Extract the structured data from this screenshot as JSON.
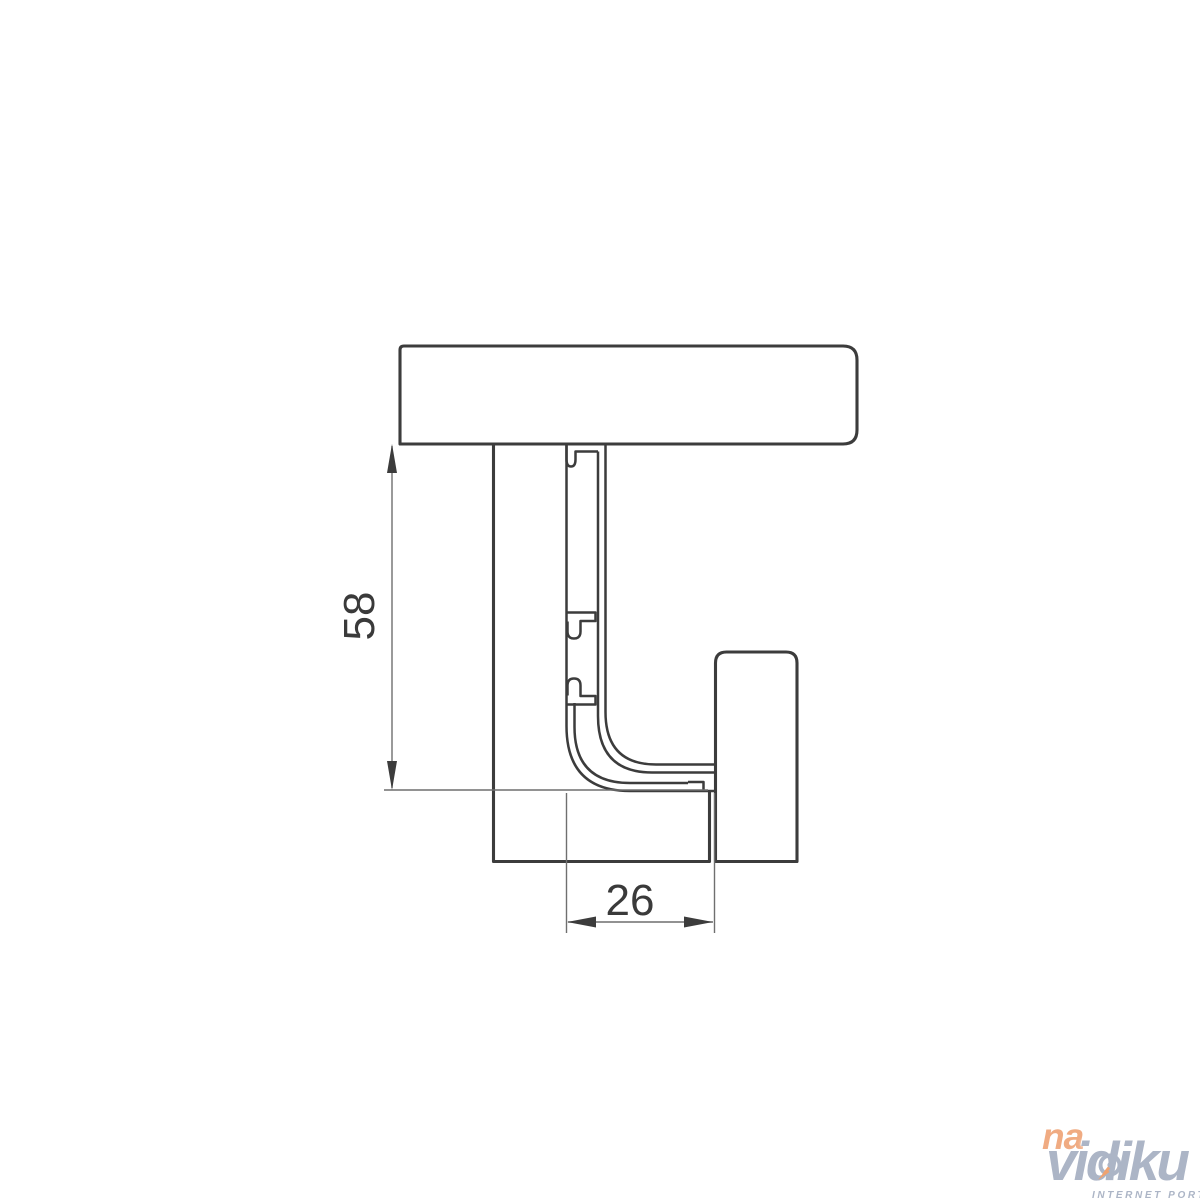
{
  "drawing": {
    "type": "technical-cross-section",
    "subject": "gola-handle-profile-installation",
    "dimensions": {
      "height": {
        "value": "58",
        "orientation": "vertical"
      },
      "width": {
        "value": "26",
        "orientation": "horizontal"
      }
    },
    "parts": [
      "countertop",
      "cabinet-panel",
      "gola-c-profile",
      "door-panel"
    ]
  },
  "watermark": {
    "prefix": "na",
    "name": "vidiku",
    "tagline": "INTERNET PORTAL"
  },
  "colors": {
    "background": "#ffffff",
    "object_line": "#3c3c3c",
    "dimension_line": "#6f6f6f",
    "dimension_text": "#3a3a3a",
    "watermark_orange": "#f0a87d",
    "watermark_gray": "#a9b2c4"
  }
}
